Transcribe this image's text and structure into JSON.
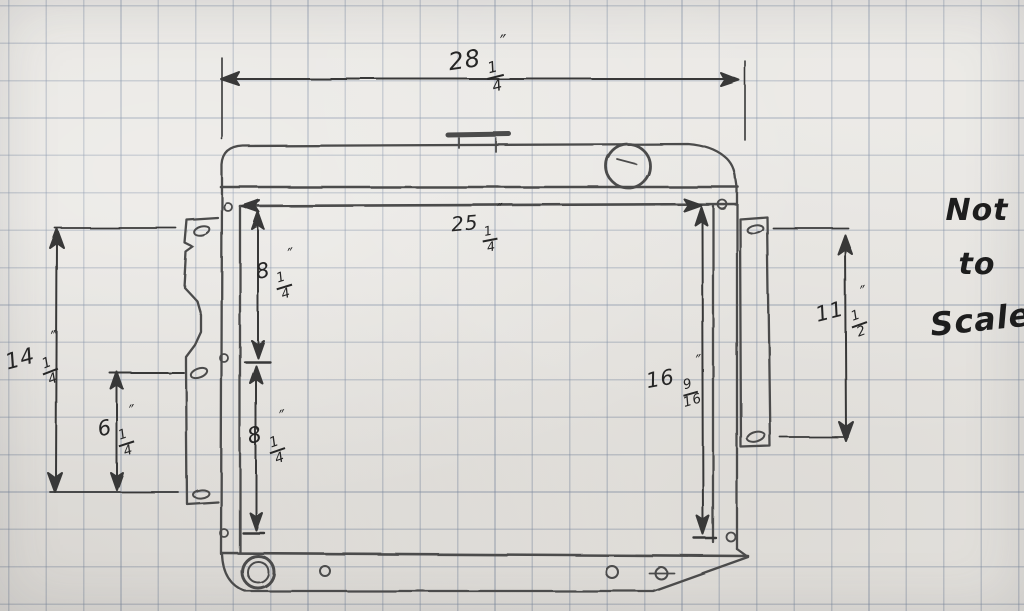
{
  "annotation": {
    "line1": "Not",
    "line2": "to",
    "line3": "Scale"
  },
  "dimensions": {
    "overall_width": {
      "whole": "28",
      "num": "1",
      "den": "4",
      "unit": "″"
    },
    "core_width": {
      "whole": "25",
      "num": "1",
      "den": "4",
      "unit": "″"
    },
    "upper_core_height": {
      "whole": "8",
      "num": "1",
      "den": "4",
      "unit": "″"
    },
    "lower_core_height": {
      "whole": "8",
      "num": "1",
      "den": "4",
      "unit": "″"
    },
    "left_bracket_height": {
      "whole": "14",
      "num": "1",
      "den": "4",
      "unit": "″"
    },
    "left_lower_offset": {
      "whole": "6",
      "num": "1",
      "den": "4",
      "unit": "″"
    },
    "core_height": {
      "whole": "16",
      "num": "9",
      "den": "16",
      "unit": "″"
    },
    "right_bracket_height": {
      "whole": "11",
      "num": "1",
      "den": "2",
      "unit": "″"
    }
  },
  "colors": {
    "paper": "#e8e6e2",
    "grid": "#76859e",
    "pencil_body": "#4b4b4b",
    "pencil_dim": "#383838",
    "ink_label": "#262626"
  },
  "subject": "Radiator dimension sketch"
}
